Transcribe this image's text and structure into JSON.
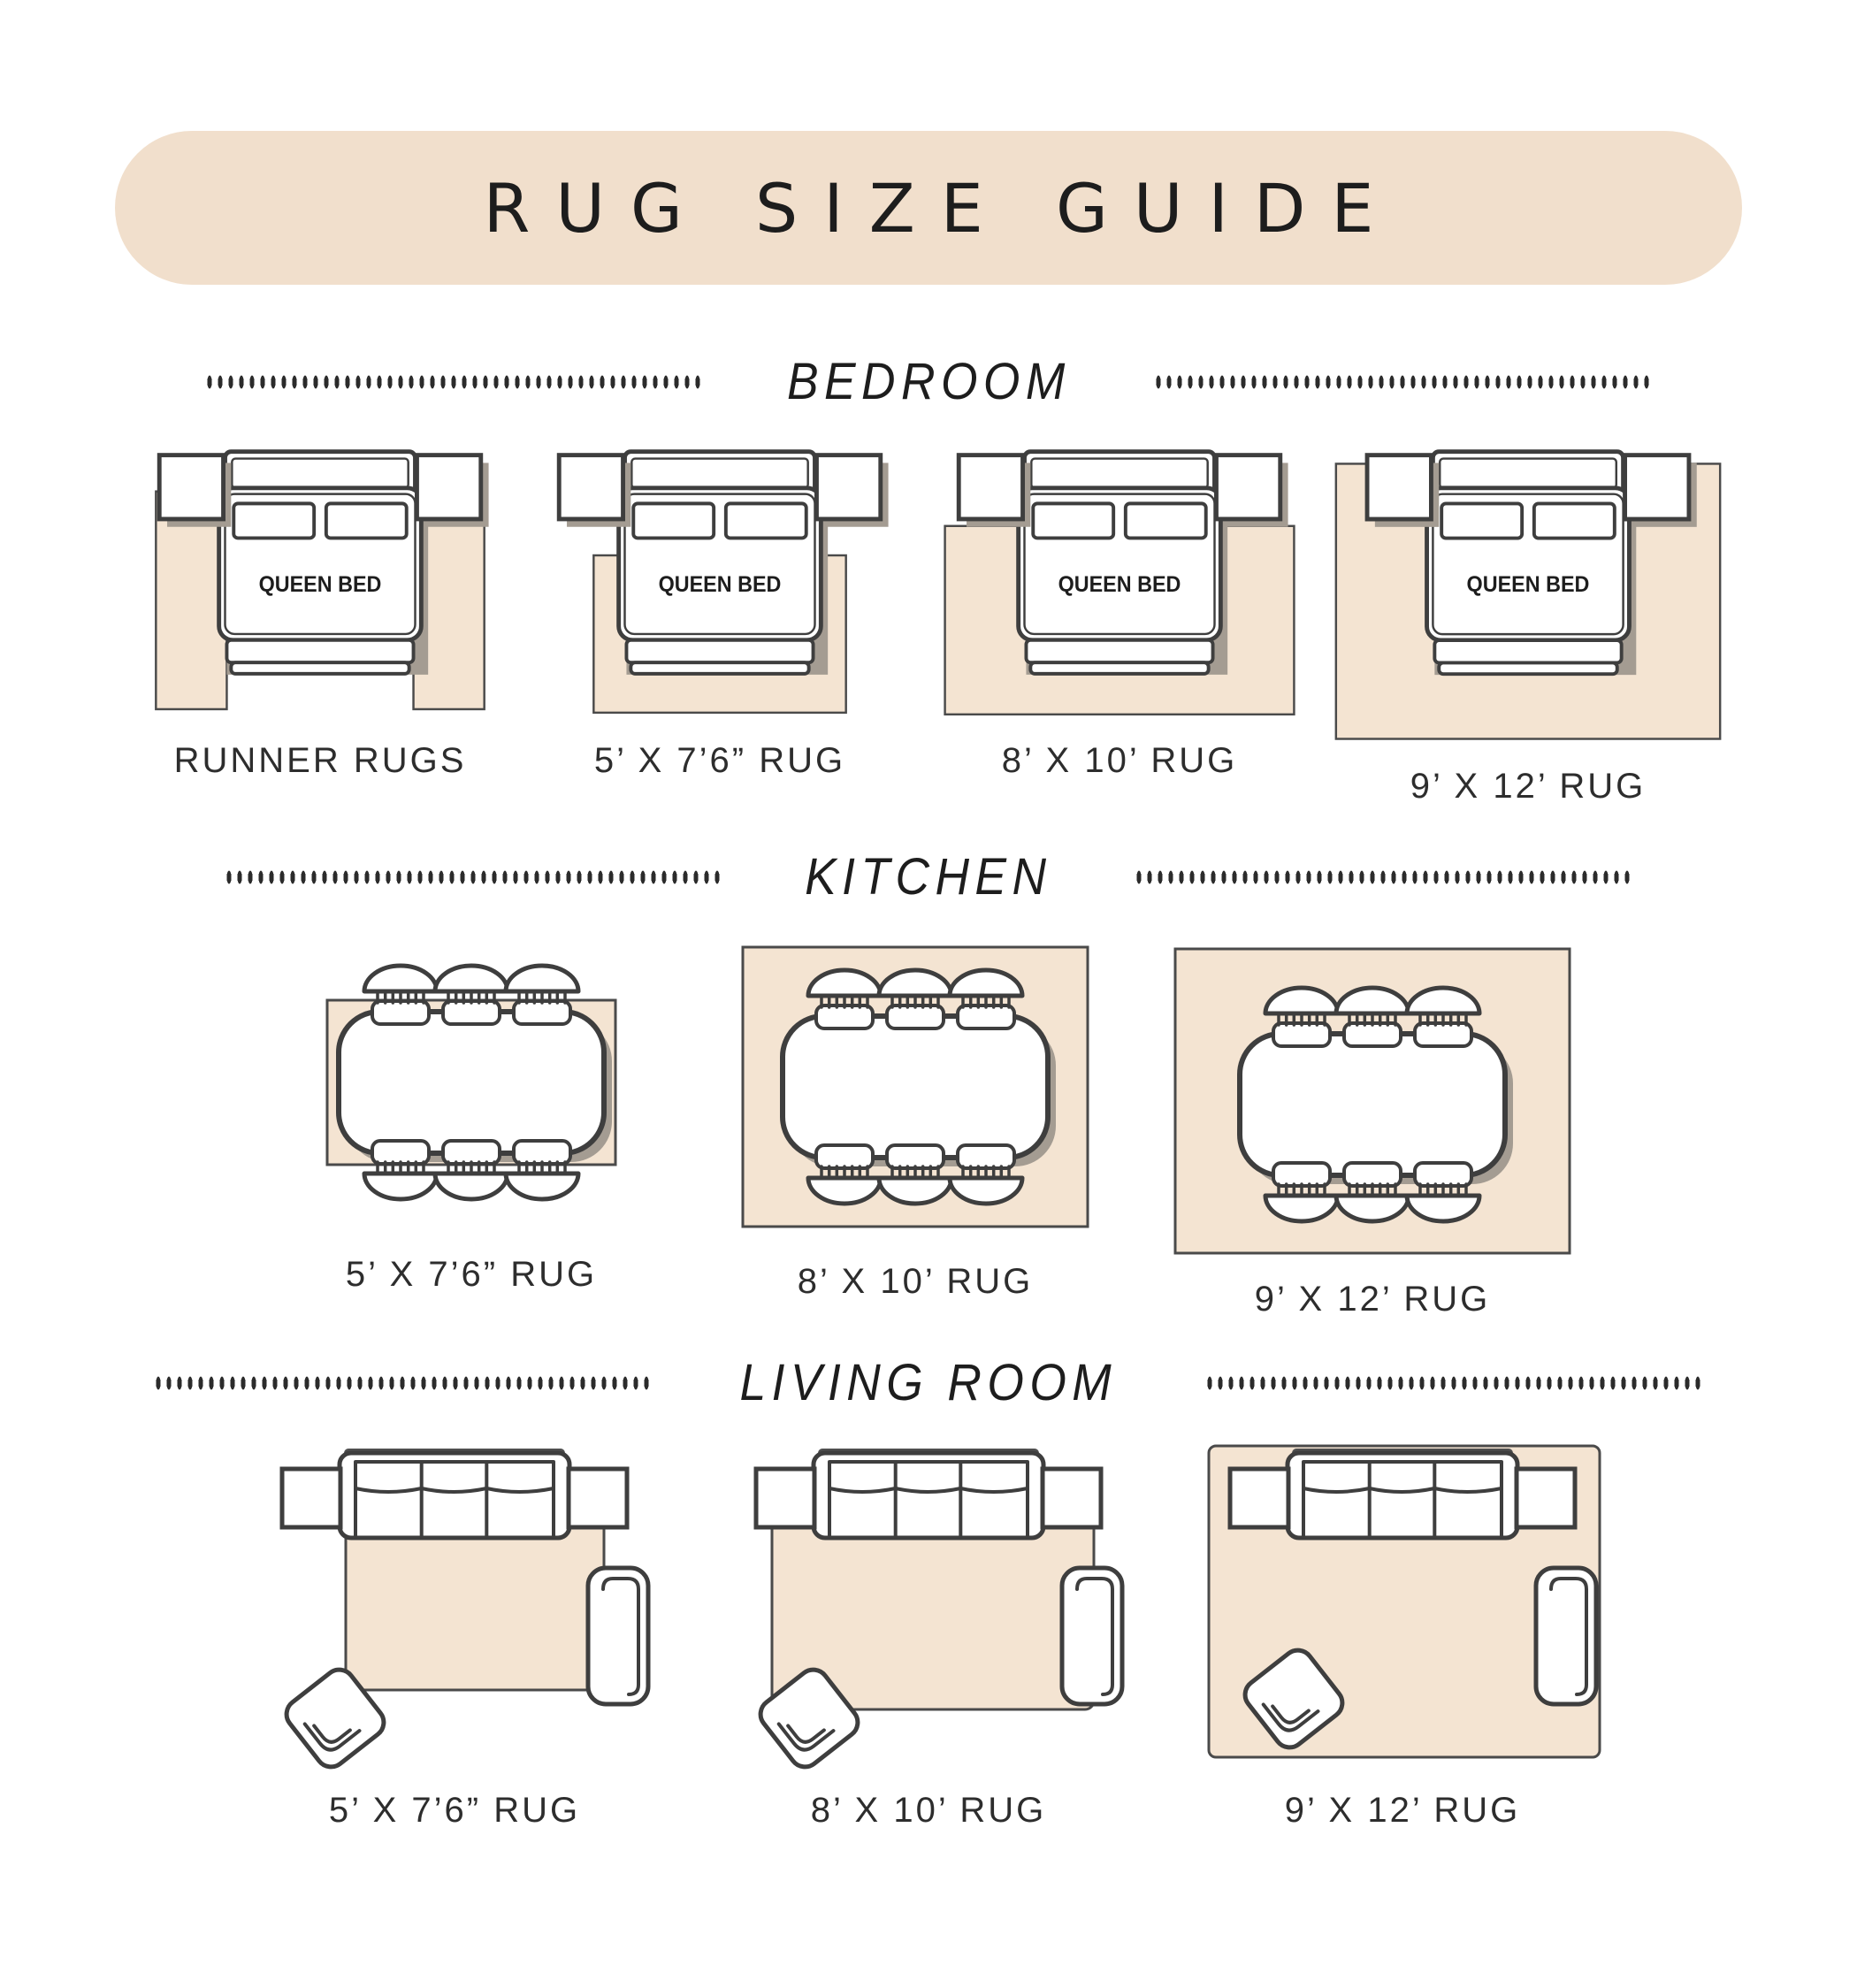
{
  "title": "RUG SIZE GUIDE",
  "furniture": {
    "bed_label": "QUEEN BED"
  },
  "colors": {
    "banner": "#f1dfcc",
    "rug": "#f4e4d2",
    "outline": "#3e3e3e",
    "shadow": "#a49c92",
    "band": "#4f4f4f",
    "text": "#1d1d1d",
    "label": "#2d2d2d",
    "dots": "#2b2b2b",
    "rugline": "#4a4a4a"
  },
  "sections": [
    {
      "heading": "BEDROOM",
      "items": [
        {
          "label": "RUNNER RUGS"
        },
        {
          "label": "5’ X 7’6” RUG"
        },
        {
          "label": "8’ X 10’ RUG"
        },
        {
          "label": "9’ X 12’ RUG"
        }
      ]
    },
    {
      "heading": "KITCHEN",
      "items": [
        {
          "label": "5’ X 7’6” RUG"
        },
        {
          "label": "8’ X 10’ RUG"
        },
        {
          "label": "9’ X 12’ RUG"
        }
      ]
    },
    {
      "heading": "LIVING ROOM",
      "items": [
        {
          "label": "5’ X 7’6” RUG"
        },
        {
          "label": "8’ X 10’ RUG"
        },
        {
          "label": "9’ X 12’ RUG"
        }
      ]
    }
  ]
}
